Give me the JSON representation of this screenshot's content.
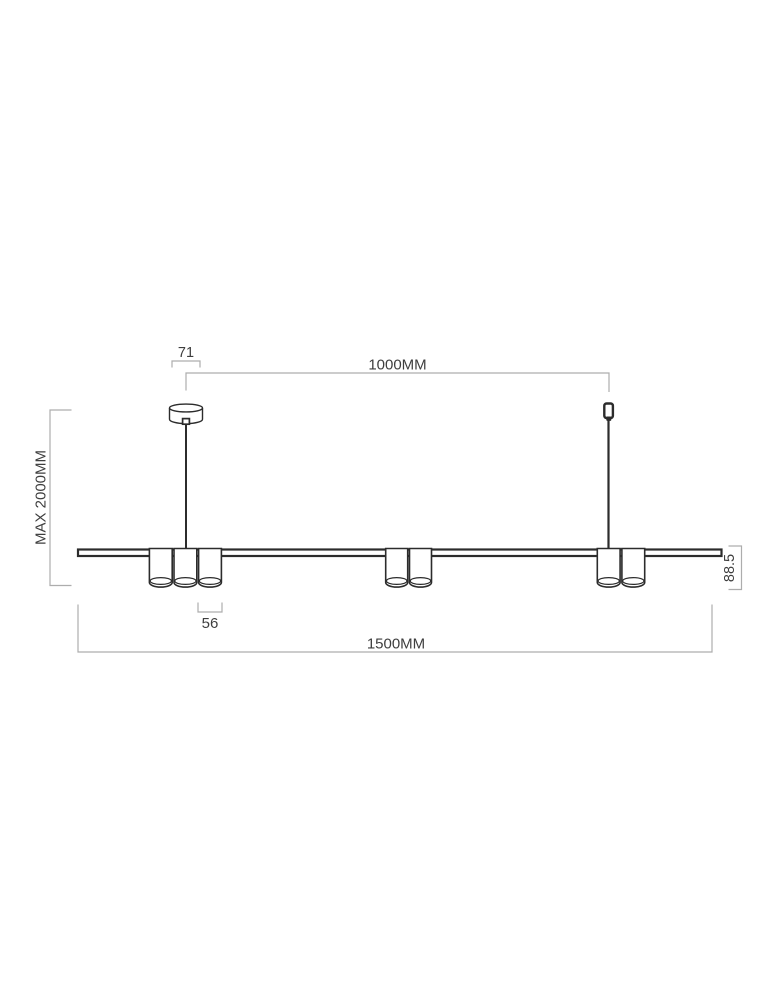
{
  "colors": {
    "background": "#ffffff",
    "fixture_line": "#2c2c2c",
    "dimension_line": "#adadad",
    "dimension_text": "#3e3e3e"
  },
  "dimensions": {
    "canopy_width": "71",
    "suspension_spacing": "1000MM",
    "max_height": "MAX 2000MM",
    "shade_height": "88.5",
    "shade_diameter": "56",
    "total_length": "1500MM"
  }
}
